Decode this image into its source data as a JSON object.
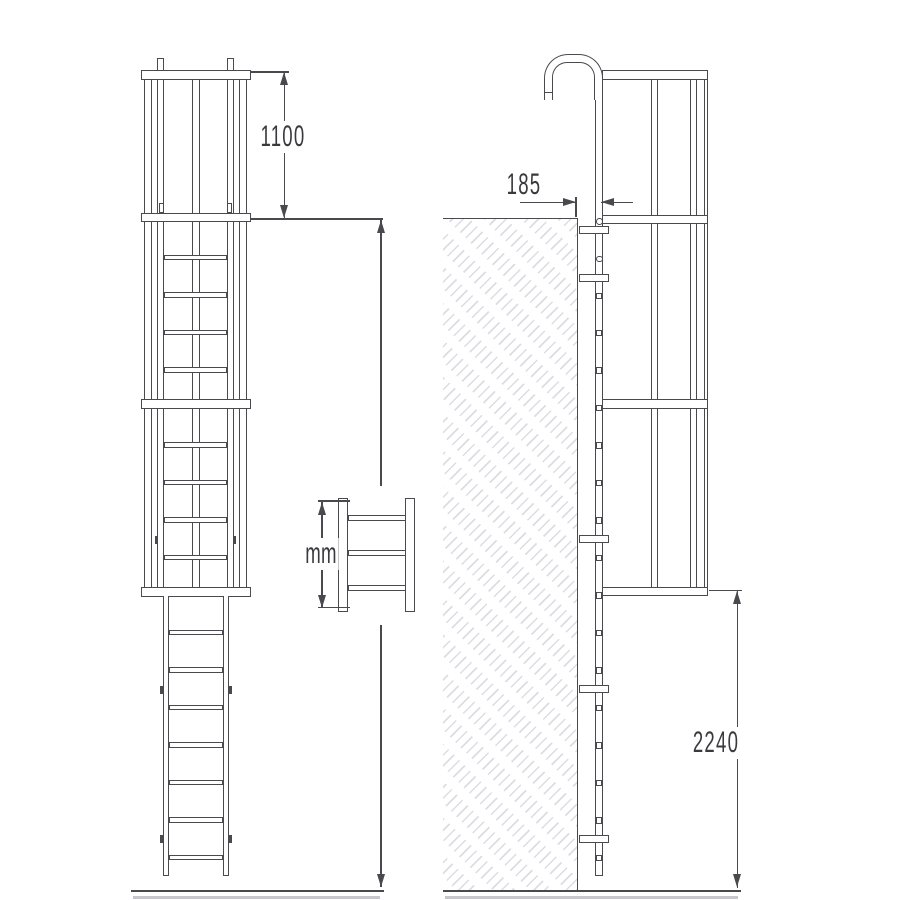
{
  "dimensions": {
    "cage_top_extension": "1100",
    "wall_standoff": "185",
    "height_unit_placeholder": "mm",
    "ground_clearance": "2240"
  },
  "colors": {
    "line": "#4a4a4e",
    "label_text": "#3a3a3e",
    "hatch": "#dcdde2",
    "background": "#ffffff"
  }
}
